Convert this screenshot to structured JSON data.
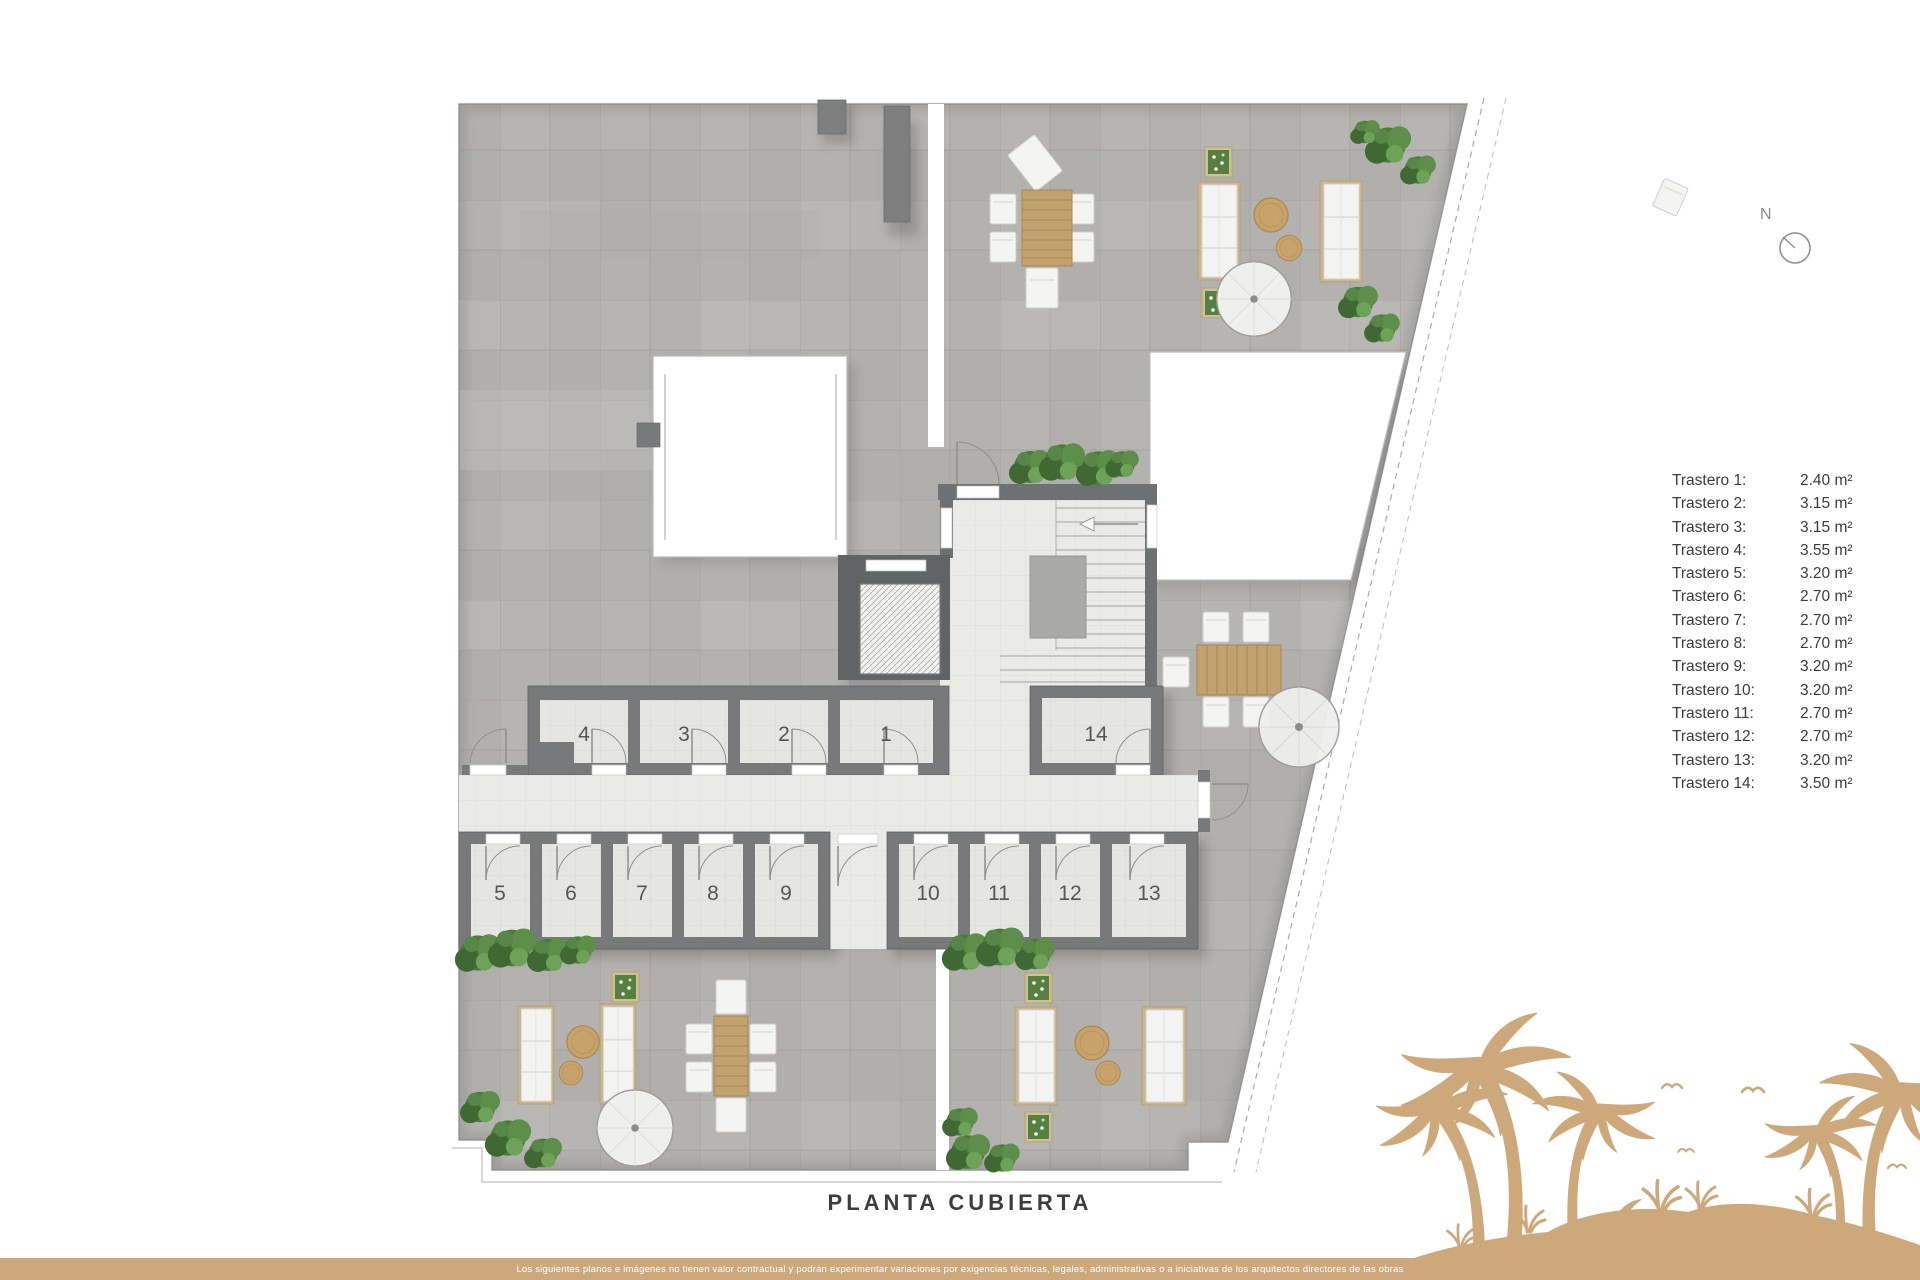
{
  "plan": {
    "title": "PLANTA CUBIERTA"
  },
  "compass": {
    "label": "N"
  },
  "legend": {
    "items": [
      {
        "label": "Trastero 1:",
        "value": "2.40 m²"
      },
      {
        "label": "Trastero 2:",
        "value": "3.15 m²"
      },
      {
        "label": "Trastero 3:",
        "value": "3.15 m²"
      },
      {
        "label": "Trastero 4:",
        "value": "3.55 m²"
      },
      {
        "label": "Trastero 5:",
        "value": "3.20 m²"
      },
      {
        "label": "Trastero 6:",
        "value": "2.70 m²"
      },
      {
        "label": "Trastero 7:",
        "value": "2.70 m²"
      },
      {
        "label": "Trastero 8:",
        "value": "2.70 m²"
      },
      {
        "label": "Trastero 9:",
        "value": "3.20 m²"
      },
      {
        "label": "Trastero 10:",
        "value": "3.20 m²"
      },
      {
        "label": "Trastero 11:",
        "value": "2.70 m²"
      },
      {
        "label": "Trastero 12:",
        "value": "2.70 m²"
      },
      {
        "label": "Trastero 13:",
        "value": "3.20 m²"
      },
      {
        "label": "Trastero 14:",
        "value": "3.50 m²"
      }
    ]
  },
  "rooms": [
    {
      "number": "1"
    },
    {
      "number": "2"
    },
    {
      "number": "3"
    },
    {
      "number": "4"
    },
    {
      "number": "5"
    },
    {
      "number": "6"
    },
    {
      "number": "7"
    },
    {
      "number": "8"
    },
    {
      "number": "9"
    },
    {
      "number": "10"
    },
    {
      "number": "11"
    },
    {
      "number": "12"
    },
    {
      "number": "13"
    },
    {
      "number": "14"
    }
  ],
  "footer": {
    "disclaimer": "Los siguientes planos e imágenes no tienen valor contractual y podrán experimentar variaciones por exigencias técnicas, legales, administrativas o a iniciativas de los arquitectos directores de las obras"
  },
  "colors": {
    "accent_tan": "#cda87b",
    "wall_gray": "#77797b",
    "terrace_tile": "#b4b2af",
    "indoor_floor": "#eaeae8",
    "hedge_green": "#4c7a3c",
    "wood": "#c2a26f",
    "text": "#3c3c3c"
  }
}
